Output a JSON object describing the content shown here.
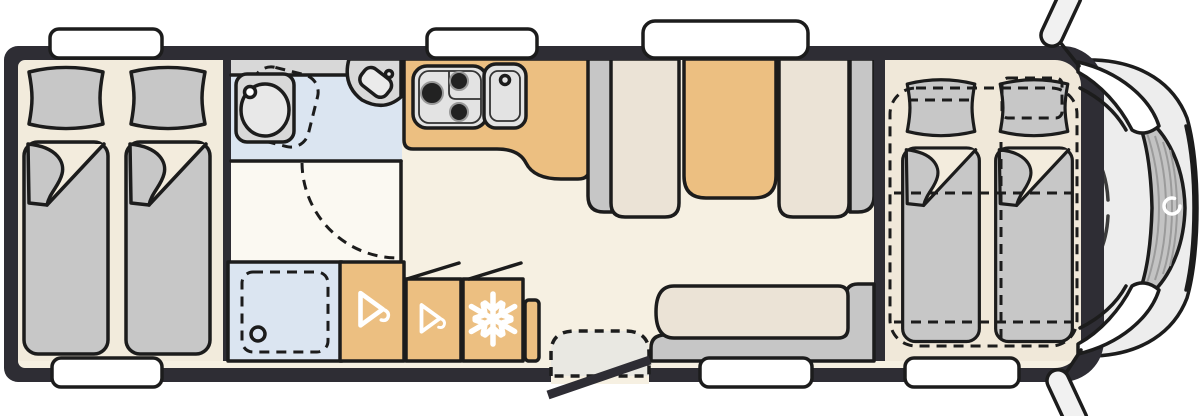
{
  "meta": {
    "title": "Motorhome floor plan (top view)",
    "view": "top-down schematic of a coachbuilt motorhome, cab on the right"
  },
  "colors": {
    "wall": "#2e2d34",
    "outline": "#1c1c1c",
    "floor-main": "#f6f0e2",
    "floor-bedroom": "#f2ebdc",
    "floor-front": "#f0e8d9",
    "floor-corridor": "#fbf9f2",
    "floor-notch": "#f3ecdd",
    "wet-blue": "#dbe5f1",
    "orange": "#ecbf81",
    "gray-furn": "#c6c6c6",
    "seat-beige": "#ebe3d6",
    "bed-gray": "#c7c7c7",
    "appliance": "#e3e3e3",
    "appliance-inner": "#d4d4d4",
    "counter-gray": "#d8d8d8",
    "step-gray": "#e9e8e2",
    "cab-body": "#ededed",
    "windshield": "#c3c3c3",
    "windshield-line": "#9b9b9b",
    "icon-white": "#ffffff",
    "window-white": "#ffffff"
  },
  "areas": [
    {
      "id": "rear-bedroom",
      "label": "Rear bedroom with two single beds"
    },
    {
      "id": "bathroom",
      "label": "Washroom: swivel toilet, corner washbasin, counter"
    },
    {
      "id": "shower",
      "label": "Shower cubicle with drain"
    },
    {
      "id": "wardrobes",
      "label": "Two wardrobes (hanger icons)"
    },
    {
      "id": "fridge",
      "label": "Refrigerator (snowflake icon)"
    },
    {
      "id": "kitchen",
      "label": "Kitchen block: 3-burner hob and sink"
    },
    {
      "id": "dinette",
      "label": "Face-to-face dinette with table"
    },
    {
      "id": "side-bench",
      "label": "L-shaped side bench"
    },
    {
      "id": "entry",
      "label": "Entry door with fold-out step"
    },
    {
      "id": "front-beds",
      "label": "Two front single beds with dashed drop-down bed outline"
    },
    {
      "id": "cab",
      "label": "Driver cab: windshield, brand swirl, side mirrors"
    }
  ],
  "icons": [
    "hanger-icon",
    "snowflake-icon",
    "brand-swirl-icon"
  ],
  "counts": {
    "windows": 6,
    "beds": 4,
    "hob_burners": 3,
    "mirrors": 2
  }
}
